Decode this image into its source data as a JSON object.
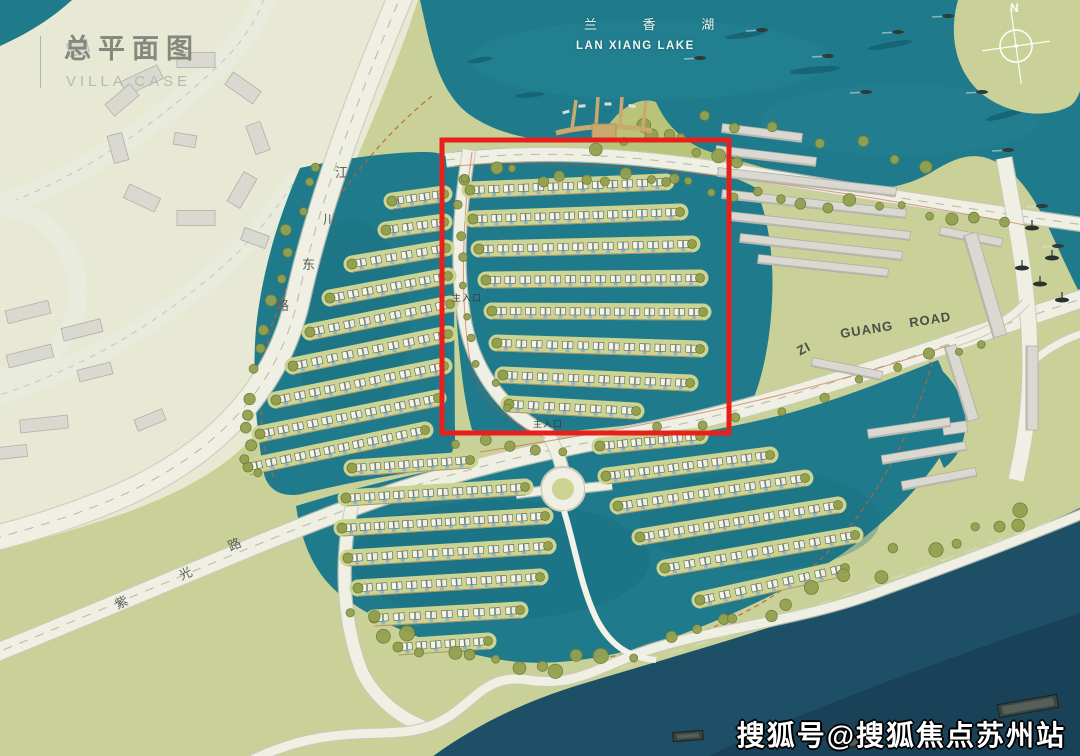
{
  "page": {
    "width": 1080,
    "height": 756
  },
  "header": {
    "title": "总平面图",
    "subtitle": "VILLA CASE"
  },
  "lake_label": {
    "cn": "兰 香 湖",
    "en": "LAN XIANG LAKE"
  },
  "compass": {
    "north": "N"
  },
  "road_labels": {
    "jiangchuan": [
      "江",
      "川",
      "东",
      "路"
    ],
    "ziguang_cn": [
      "紫",
      "光",
      "路"
    ],
    "ziguang_en": [
      "ZI",
      "GUANG",
      "ROAD"
    ]
  },
  "entrances": {
    "west": "主入口",
    "south": "主入口"
  },
  "watermark": "搜狐号@搜狐焦点苏州站",
  "colors": {
    "land": "#c9d198",
    "land_pale": "#e7e9d4",
    "water": "#1f7b8c",
    "water_deep": "#186a7c",
    "river": "#1d4f66",
    "river_deep": "#16384d",
    "road": "#efefe4",
    "road_edge": "#c9c9b8",
    "house": "#f5f6f0",
    "pool": "#85b6d3",
    "tree": "#93a14f",
    "building": "#d9d9d2",
    "highlight": "#e8201c",
    "boundary": "#c06038",
    "band": "#ccd494",
    "berm": "#b9c47b",
    "pier": "#c9a96f"
  }
}
